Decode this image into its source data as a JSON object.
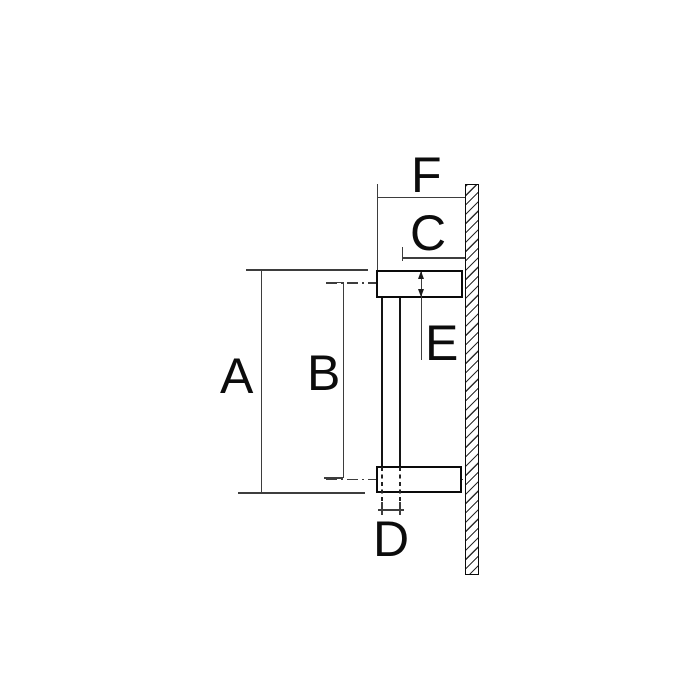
{
  "title": "Side-view technical drawing of a wall-mounted pull handle with dimension callouts",
  "colors": {
    "background": "#ffffff",
    "outline": "#0a0a0a",
    "dimension_line": "#3d3d3d",
    "label_text": "#0c0c0c"
  },
  "dimension_labels": {
    "A": "A",
    "B": "B",
    "C": "C",
    "D": "D",
    "E": "E",
    "F": "F"
  },
  "parts": {
    "wall": "hatched wall / door section",
    "top_bracket": "upper standoff bracket",
    "bottom_bracket": "lower standoff bracket",
    "bar": "vertical handle bar"
  },
  "dimension_meanings": {
    "A": "overall height over brackets",
    "B": "centre-to-centre bracket distance",
    "C": "clearance from bar to wall",
    "D": "bar diameter",
    "E": "bracket thickness",
    "F": "total projection from wall"
  }
}
